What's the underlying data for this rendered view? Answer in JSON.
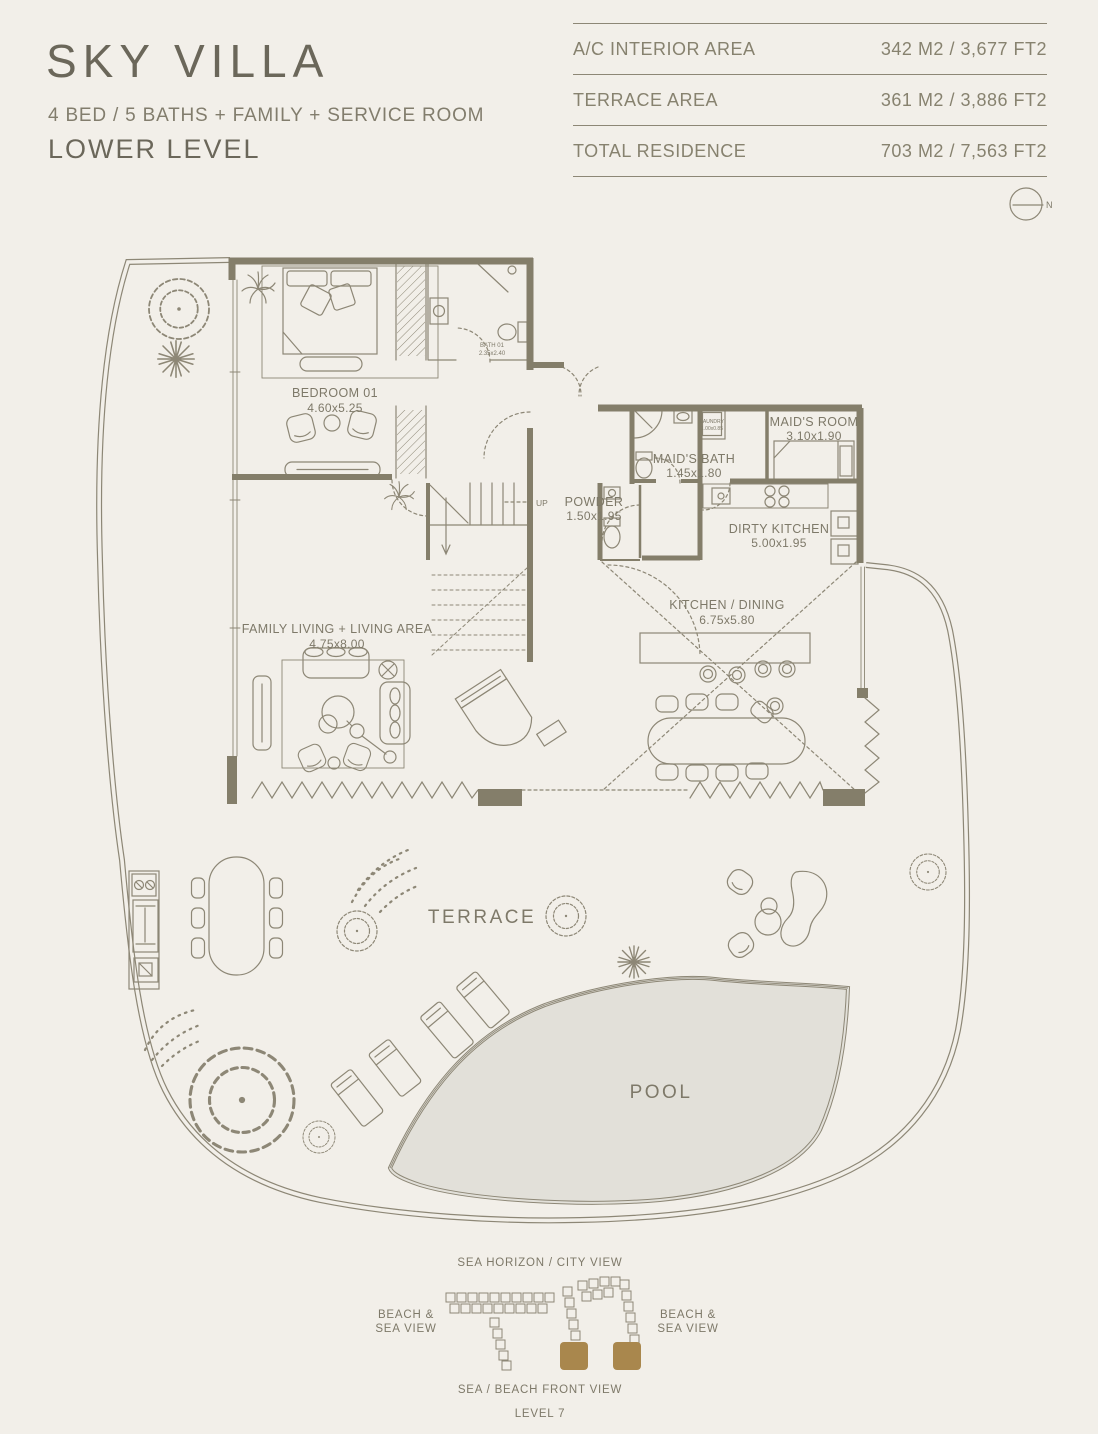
{
  "header": {
    "title": "SKY VILLA",
    "subtitle": "4 BED / 5 BATHS + FAMILY + SERVICE ROOM",
    "level": "LOWER LEVEL"
  },
  "area_table": {
    "rows": [
      {
        "label": "A/C INTERIOR AREA",
        "value": "342 M2 / 3,677 FT2"
      },
      {
        "label": "TERRACE AREA",
        "value": "361 M2 / 3,886 FT2"
      },
      {
        "label": "TOTAL RESIDENCE",
        "value": "703 M2 / 7,563 FT2"
      }
    ]
  },
  "compass": {
    "label": "N"
  },
  "plan": {
    "rooms": [
      {
        "name": "BEDROOM 01",
        "dims": "4.60x5.25"
      },
      {
        "name": "BATH 01",
        "dims": "2.35x2.40"
      },
      {
        "name": "FAMILY LIVING + LIVING AREA",
        "dims": "4.75x8.00"
      },
      {
        "name": "POWDER",
        "dims": "1.50x1.95"
      },
      {
        "name": "MAID'S BATH",
        "dims": "1.45x1.80"
      },
      {
        "name": "LAUNDRY",
        "dims": "1.00x0.85"
      },
      {
        "name": "MAID'S ROOM",
        "dims": "3.10x1.90"
      },
      {
        "name": "DIRTY KITCHEN",
        "dims": "5.00x1.95"
      },
      {
        "name": "KITCHEN / DINING",
        "dims": "6.75x5.80"
      }
    ],
    "stair_label": "UP",
    "terrace_label": "TERRACE",
    "pool_label": "POOL"
  },
  "key_plan": {
    "top_label": "SEA HORIZON / CITY VIEW",
    "left_label_line1": "BEACH &",
    "left_label_line2": "SEA VIEW",
    "right_label_line1": "BEACH &",
    "right_label_line2": "SEA VIEW",
    "bottom_label": "SEA / BEACH FRONT VIEW",
    "level_label": "LEVEL 7"
  },
  "colors": {
    "background": "#f2efe9",
    "line": "#8d8776",
    "wall": "#847e6a",
    "text": "#7e7969",
    "title": "#6b675a",
    "pool_fill": "#e2e0d9",
    "highlight": "#a9874d"
  }
}
